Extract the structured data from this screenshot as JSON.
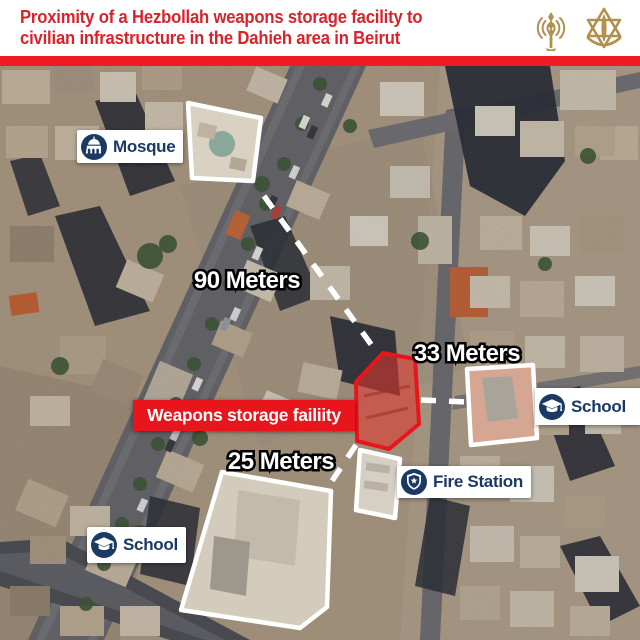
{
  "header": {
    "title_line1": "Proximity of a Hezbollah weapons storage facility to",
    "title_line2": "civilian infrastructure in the Dahieh area in Beirut",
    "logos": [
      {
        "name": "idf-spokesperson-antenna-logo"
      },
      {
        "name": "idf-emblem-logo"
      }
    ]
  },
  "colors": {
    "title_red": "#d8232b",
    "bar_red": "#ee1b23",
    "label_navy": "#1a3a64",
    "highlight_red": "#e8151c",
    "label_bg": "#ffffff",
    "distance_text": "#ffffff",
    "logo_gold": "#b2904e"
  },
  "map": {
    "facility": {
      "label": "Weapons storage failiity"
    },
    "sites": {
      "mosque": {
        "label": "Mosque",
        "icon": "mosque-icon"
      },
      "school_right": {
        "label": "School",
        "icon": "school-icon"
      },
      "school_bottom": {
        "label": "School",
        "icon": "school-icon"
      },
      "fire_station": {
        "label": "Fire Station",
        "icon": "badge-icon"
      }
    },
    "distances": {
      "mosque_to_facility": "90 Meters",
      "school_right_to_facility": "33 Meters",
      "school_bottom_to_facility": "25 Meters"
    }
  }
}
